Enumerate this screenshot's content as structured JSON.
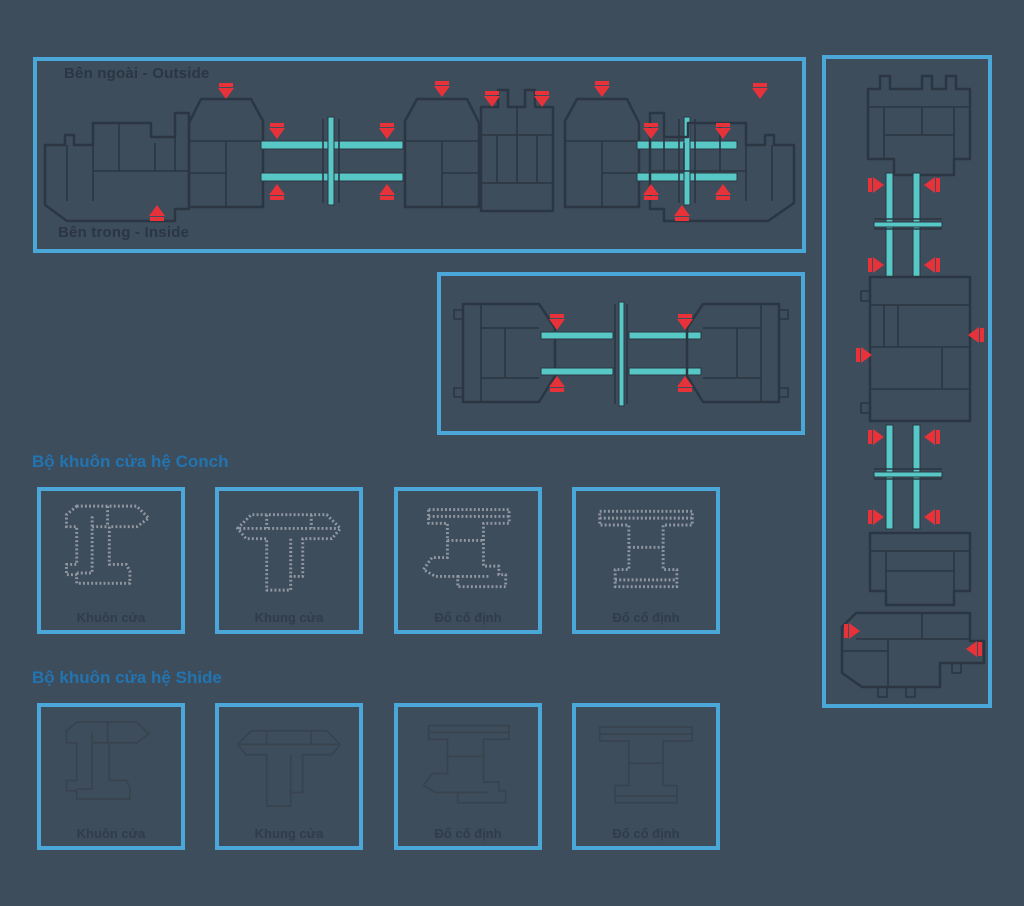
{
  "colors": {
    "bg": "#3d4d5c",
    "border": "#4aa7d7",
    "heading": "#2274b1",
    "dark": "#2b3642",
    "red": "#e8323a",
    "teal": "#57c8c6",
    "label": "#313c48",
    "conch": "#9298a1",
    "shide": "#39434e"
  },
  "top_panel": {
    "outside_label": "Bên ngoài - Outside",
    "inside_label": "Bên trong - Inside"
  },
  "sections": [
    {
      "heading": "Bộ khuôn cửa hệ Conch",
      "items": [
        {
          "label": "Khuôn cửa"
        },
        {
          "label": "Khung cửa"
        },
        {
          "label": "Đố cố định"
        },
        {
          "label": "Đố cố định"
        }
      ]
    },
    {
      "heading": "Bộ khuôn cửa hệ Shide",
      "items": [
        {
          "label": "Khuôn cửa"
        },
        {
          "label": "Khung cửa"
        },
        {
          "label": "Đố cố định"
        },
        {
          "label": "Đố cố định"
        }
      ]
    }
  ]
}
